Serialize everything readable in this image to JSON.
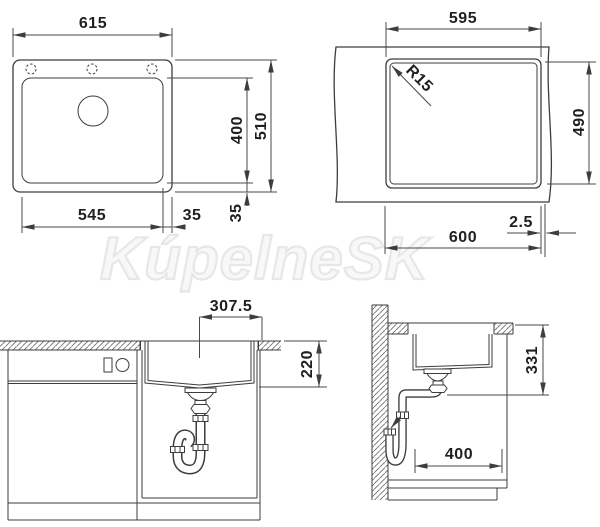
{
  "watermark": {
    "text": "KúpelneSK"
  },
  "drawing": {
    "top_view": {
      "overall_width": "615",
      "bowl_height": "400",
      "overall_height": "510",
      "bowl_width": "545",
      "side_offset": "35",
      "bottom_offset": "35"
    },
    "cutout_view": {
      "cutout_width": "595",
      "corner_radius": "R15",
      "cutout_height": "490",
      "cabinet_width": "600",
      "edge_offset": "2.5"
    },
    "front_view": {
      "center_to_edge": "307.5",
      "bowl_depth": "220"
    },
    "side_view": {
      "outlet_height": "331",
      "cabinet_clearance": "400"
    }
  },
  "colors": {
    "line": "#3d3d3d",
    "text": "#1f1f1f",
    "watermark_stroke": "#e7e7e7",
    "background": "#ffffff"
  }
}
